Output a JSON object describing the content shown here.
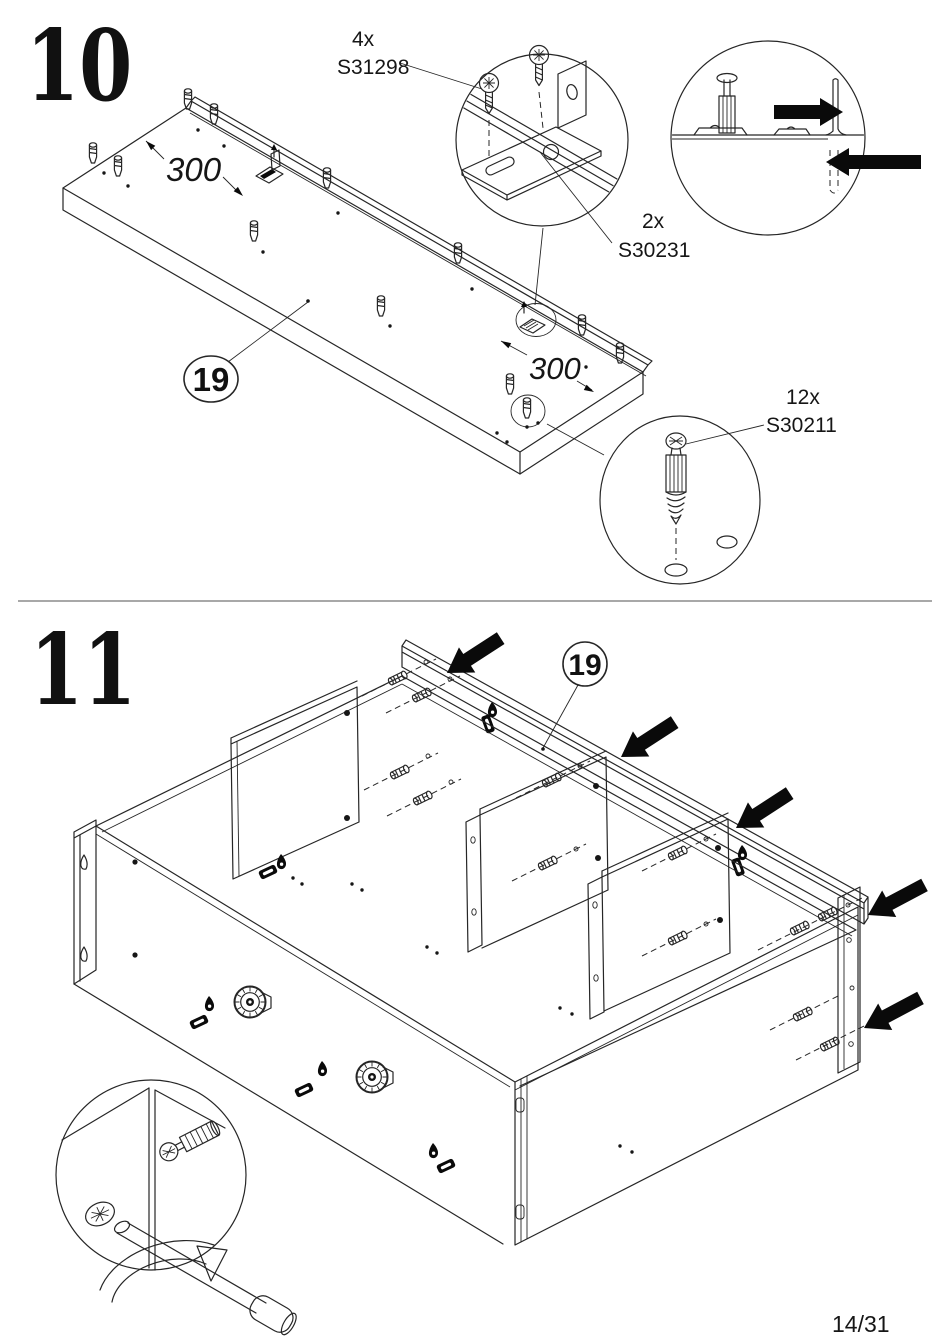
{
  "page": {
    "number": "14/31"
  },
  "colors": {
    "line": "#262626",
    "arrow": "#0a0a0a",
    "divider": "#a8a8a8",
    "background": "#ffffff"
  },
  "steps": [
    {
      "number": "10",
      "part_bubble": "19",
      "dim_back": "300",
      "dim_front": "300",
      "hardware": [
        {
          "qty": "4x",
          "part": "S31298"
        },
        {
          "qty": "2x",
          "part": "S30231"
        },
        {
          "qty": "12x",
          "part": "S30211"
        }
      ]
    },
    {
      "number": "11",
      "part_bubble": "19"
    }
  ]
}
